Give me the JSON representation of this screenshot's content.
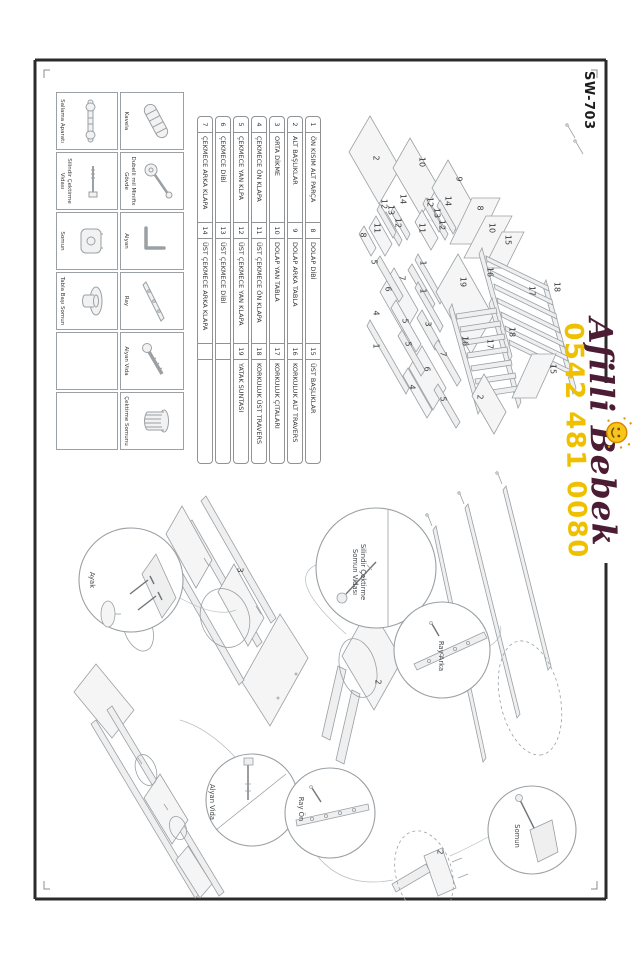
{
  "page": {
    "model": "SW-703"
  },
  "watermark": {
    "brand": "Afilli Bebek",
    "phone": "0542 481 0080",
    "brand_color": "#4b1c33",
    "phone_color": "#efc000",
    "sun_icon": "smiley-sun-icon"
  },
  "parts_table": {
    "rows": [
      {
        "a_no": "1",
        "a": "ÖN KISIM ALT PARÇA",
        "b_no": "8",
        "b": "DOLAP DİBİ",
        "c_no": "15",
        "c": "ÜST BAŞLIKLAR"
      },
      {
        "a_no": "2",
        "a": "ALT BAŞLIKLAR",
        "b_no": "9",
        "b": "DOLAP ARKA TABLA",
        "c_no": "16",
        "c": "KORKULUK ALT TRAVERS"
      },
      {
        "a_no": "3",
        "a": "ORTA DİKME",
        "b_no": "10",
        "b": "DOLAP YAN TABLA",
        "c_no": "17",
        "c": "KORKULUK ÇITALARI"
      },
      {
        "a_no": "4",
        "a": "ÇEKMECE ÖN KLAPA",
        "b_no": "11",
        "b": "ÜST ÇEKMECE ÖN KLAPA",
        "c_no": "18",
        "c": "KORKULUK ÜST TRAVERS"
      },
      {
        "a_no": "5",
        "a": "ÇEKMECE YAN KLPA",
        "b_no": "12",
        "b": "ÜST ÇEKMECE YAN KLAPA",
        "c_no": "19",
        "c": "YATAK SUNTASI"
      },
      {
        "a_no": "6",
        "a": "ÇEKMECE DİBİ",
        "b_no": "13",
        "b": "ÜST ÇEKMECE DİBİ",
        "c_no": "",
        "c": ""
      },
      {
        "a_no": "7",
        "a": "ÇEKMECE ARKA KLAPA",
        "b_no": "14",
        "b": "ÜST ÇEKMECE ARKA KLAPA",
        "c_no": "",
        "c": ""
      }
    ]
  },
  "hardware": {
    "cells": [
      {
        "label": "Kavela",
        "icon": "dowel-icon"
      },
      {
        "label": "Dubelli mil Minifix Gövde",
        "icon": "minifix-icon"
      },
      {
        "label": "Alyan",
        "icon": "allen-key-icon"
      },
      {
        "label": "Ray",
        "icon": "rail-icon"
      },
      {
        "label": "Alyan Vida",
        "icon": "allen-bolt-icon"
      },
      {
        "label": "Çektirme Somunu",
        "icon": "barrel-nut-icon"
      },
      {
        "label": "Sallama Aparatı",
        "icon": "swing-rod-icon"
      },
      {
        "label": "Silindir Çektirme Vidası",
        "icon": "cam-screw-icon"
      },
      {
        "label": "Somun",
        "icon": "nut-icon"
      },
      {
        "label": "Tabla Başı Somun",
        "icon": "flange-nut-icon"
      },
      {
        "label": "",
        "icon": ""
      },
      {
        "label": "",
        "icon": ""
      }
    ]
  },
  "captions": [
    "Ayak",
    "Silindir Çektirme Somun Vidası",
    "Ray Arka",
    "Alyan Vida",
    "Ray Ön",
    "Somun"
  ],
  "diagram_labels": [
    {
      "t": "2",
      "x": 100,
      "y": 232
    },
    {
      "t": "10",
      "x": 104,
      "y": 186
    },
    {
      "t": "9",
      "x": 121,
      "y": 149
    },
    {
      "t": "8",
      "x": 150,
      "y": 128
    },
    {
      "t": "10",
      "x": 170,
      "y": 116
    },
    {
      "t": "15",
      "x": 182,
      "y": 100
    },
    {
      "t": "8",
      "x": 177,
      "y": 245
    },
    {
      "t": "11",
      "x": 170,
      "y": 231
    },
    {
      "t": "12",
      "x": 146,
      "y": 224
    },
    {
      "t": "13",
      "x": 152,
      "y": 217
    },
    {
      "t": "14",
      "x": 141,
      "y": 205
    },
    {
      "t": "12",
      "x": 165,
      "y": 210
    },
    {
      "t": "11",
      "x": 170,
      "y": 186
    },
    {
      "t": "12",
      "x": 144,
      "y": 178
    },
    {
      "t": "13",
      "x": 155,
      "y": 171
    },
    {
      "t": "14",
      "x": 143,
      "y": 160
    },
    {
      "t": "12",
      "x": 167,
      "y": 166
    },
    {
      "t": "5",
      "x": 204,
      "y": 234
    },
    {
      "t": "7",
      "x": 220,
      "y": 206
    },
    {
      "t": "6",
      "x": 231,
      "y": 220
    },
    {
      "t": "1",
      "x": 205,
      "y": 185
    },
    {
      "t": "4",
      "x": 255,
      "y": 232
    },
    {
      "t": "1",
      "x": 233,
      "y": 185
    },
    {
      "t": "5",
      "x": 263,
      "y": 203
    },
    {
      "t": "3",
      "x": 266,
      "y": 180
    },
    {
      "t": "1",
      "x": 288,
      "y": 232
    },
    {
      "t": "5",
      "x": 286,
      "y": 200
    },
    {
      "t": "7",
      "x": 296,
      "y": 165
    },
    {
      "t": "6",
      "x": 311,
      "y": 181
    },
    {
      "t": "4",
      "x": 329,
      "y": 196
    },
    {
      "t": "5",
      "x": 341,
      "y": 165
    },
    {
      "t": "2",
      "x": 339,
      "y": 128
    },
    {
      "t": "19",
      "x": 224,
      "y": 145
    },
    {
      "t": "16",
      "x": 214,
      "y": 118
    },
    {
      "t": "17",
      "x": 233,
      "y": 76
    },
    {
      "t": "18",
      "x": 229,
      "y": 51
    },
    {
      "t": "18",
      "x": 274,
      "y": 96
    },
    {
      "t": "17",
      "x": 286,
      "y": 118
    },
    {
      "t": "16",
      "x": 283,
      "y": 143
    },
    {
      "t": "15",
      "x": 311,
      "y": 55
    }
  ],
  "assembly_labels": [
    {
      "t": "3",
      "x": 512,
      "y": 368
    },
    {
      "t": "2",
      "x": 624,
      "y": 230
    },
    {
      "t": "2",
      "x": 794,
      "y": 168
    }
  ]
}
